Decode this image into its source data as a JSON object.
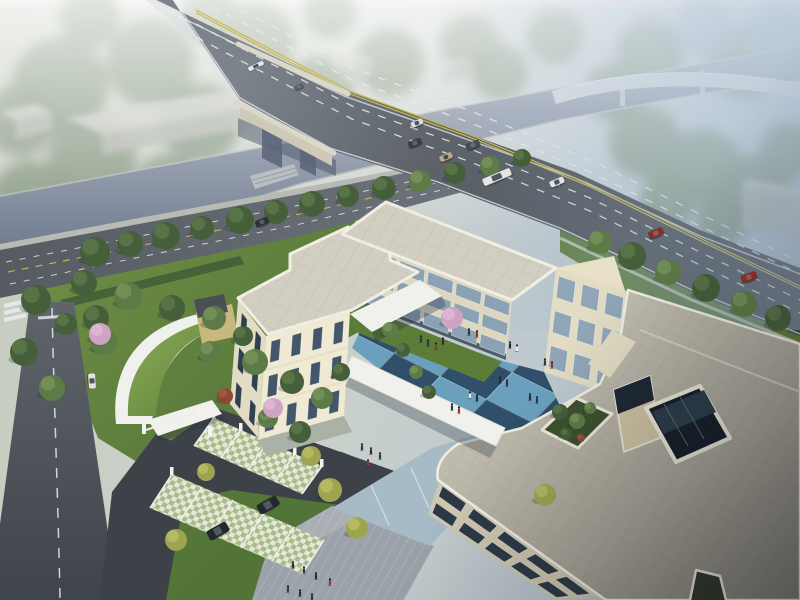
{
  "scene": {
    "type": "aerial-architectural-rendering",
    "colors": {
      "haze_top": "#ded6d5",
      "sky_left": "#c6ccbe",
      "sky_mid": "#ccd2cb",
      "sky_right": "#b3c2d1",
      "forest_green": "#7e9179",
      "forest_blue": "#93a7b5",
      "water": "#6f7b90",
      "water_far": "#97a4b3",
      "bank": "#b2b8b2",
      "road_asphalt": "#46494f",
      "road_far": "#7c838b",
      "marking_white": "#e9edef",
      "marking_yellow": "#c9b94f",
      "bridge_parapet": "#dcd8ca",
      "bridge_side": "#cfc9b8",
      "viaduct": "#c7ced4",
      "street_asphalt": "#565b62",
      "sidewalk": "#b7bbb3",
      "warehouse_roof": "#c3c6bd",
      "warehouse_face": "#acb1a8",
      "lawn": "#6e8d45",
      "lawn_dark": "#527438",
      "hedge": "#3f5c37",
      "tree_dark": "#465f3b",
      "tree_dark_hi": "#5d784a",
      "tree_mid": "#5d7b47",
      "tree_mid_hi": "#79955b",
      "tree_yellow": "#9fa451",
      "tree_yellow_hi": "#bcbe69",
      "blossom": "#cfa3c3",
      "blossom_hi": "#dfb9d3",
      "tree_red": "#8c4837",
      "tree_red_hi": "#a25c45",
      "green_roof": "#7fa24e",
      "green_roof_dark": "#5d8039",
      "drive_asphalt": "#3d4248",
      "left_road": "#54585f",
      "paver": "#c6d2ae",
      "paver_line": "#eef0e8",
      "plaza": "#9ba2a9",
      "plaza_hi": "#b2b8be",
      "path_blue": "#a7bbc7",
      "ct_light": "#6aa0bd",
      "ct_dark": "#2f4f6a",
      "ct_grass": "#5c7d38",
      "wall_lit": "#f0e9d3",
      "wall_mid": "#e3dcc4",
      "wall_shadow": "#ded7bf",
      "wall_dark": "#cfc8b0",
      "parapet": "#f1eee3",
      "roof_light": "#d2cec1",
      "roof_mid": "#c0bcae",
      "roof_dark": "#837f77",
      "glass_band": "#8ba1b4",
      "glass_dark": "#36465a",
      "arcade": "#4d5d6c",
      "atrium_dark": "#151e29",
      "canopy": "#f0f1ec",
      "sand": "#c9b87e",
      "car_dark": "#24282e"
    },
    "forest": {
      "format": [
        "x",
        "y",
        "r",
        "variant"
      ],
      "items": [
        [
          60,
          85,
          48,
          "g"
        ],
        [
          150,
          62,
          44,
          "g"
        ],
        [
          255,
          42,
          40,
          "g"
        ],
        [
          92,
          160,
          44,
          "g"
        ],
        [
          200,
          122,
          40,
          "g"
        ],
        [
          318,
          92,
          36,
          "g"
        ],
        [
          30,
          198,
          38,
          "g"
        ],
        [
          168,
          188,
          34,
          "g"
        ],
        [
          390,
          62,
          34,
          "g"
        ],
        [
          470,
          44,
          30,
          "g"
        ],
        [
          555,
          36,
          28,
          "g"
        ],
        [
          650,
          52,
          34,
          "g"
        ],
        [
          745,
          62,
          38,
          "g"
        ],
        [
          615,
          92,
          30,
          "g"
        ],
        [
          500,
          72,
          28,
          "g"
        ],
        [
          705,
          28,
          30,
          "b"
        ],
        [
          775,
          35,
          32,
          "b"
        ],
        [
          645,
          142,
          36,
          "g"
        ],
        [
          703,
          166,
          38,
          "g"
        ],
        [
          756,
          190,
          36,
          "g"
        ],
        [
          788,
          150,
          28,
          "g"
        ],
        [
          668,
          200,
          28,
          "g"
        ],
        [
          722,
          220,
          26,
          "g"
        ],
        [
          90,
          18,
          30,
          "g"
        ],
        [
          210,
          14,
          28,
          "g"
        ],
        [
          330,
          12,
          26,
          "g"
        ],
        [
          20,
          120,
          36,
          "g"
        ]
      ]
    },
    "trees": {
      "format": [
        "x",
        "y",
        "r",
        "variant"
      ],
      "items": [
        [
          95,
          252,
          15,
          "dark"
        ],
        [
          130,
          244,
          13,
          "dark"
        ],
        [
          166,
          236,
          14,
          "dark"
        ],
        [
          202,
          228,
          12,
          "dark"
        ],
        [
          240,
          220,
          14,
          "dark"
        ],
        [
          276,
          212,
          12,
          "dark"
        ],
        [
          312,
          204,
          13,
          "dark"
        ],
        [
          348,
          196,
          11,
          "dark"
        ],
        [
          384,
          188,
          12,
          "dark"
        ],
        [
          420,
          181,
          11,
          "mid"
        ],
        [
          455,
          173,
          11,
          "dark"
        ],
        [
          490,
          166,
          10,
          "mid"
        ],
        [
          522,
          158,
          9,
          "dark"
        ],
        [
          600,
          242,
          12,
          "mid"
        ],
        [
          632,
          256,
          14,
          "dark"
        ],
        [
          668,
          272,
          13,
          "mid"
        ],
        [
          706,
          288,
          14,
          "dark"
        ],
        [
          744,
          304,
          13,
          "mid"
        ],
        [
          778,
          318,
          13,
          "dark"
        ],
        [
          84,
          283,
          13,
          "dark"
        ],
        [
          128,
          296,
          14,
          "mid"
        ],
        [
          172,
          308,
          13,
          "dark"
        ],
        [
          214,
          318,
          12,
          "mid"
        ],
        [
          66,
          324,
          11,
          "dark"
        ],
        [
          104,
          342,
          13,
          "mid"
        ],
        [
          36,
          300,
          15,
          "dark"
        ],
        [
          24,
          352,
          14,
          "dark"
        ],
        [
          52,
          388,
          13,
          "mid"
        ],
        [
          96,
          318,
          13,
          "dark"
        ],
        [
          255,
          362,
          13,
          "mid"
        ],
        [
          292,
          382,
          12,
          "dark"
        ],
        [
          322,
          398,
          11,
          "mid"
        ],
        [
          341,
          372,
          9,
          "dark"
        ],
        [
          268,
          418,
          10,
          "mid"
        ],
        [
          300,
          432,
          11,
          "dark"
        ],
        [
          243,
          336,
          10,
          "dark"
        ],
        [
          210,
          352,
          11,
          "mid"
        ],
        [
          330,
          490,
          12,
          "yellow"
        ],
        [
          357,
          528,
          11,
          "yellow"
        ],
        [
          176,
          540,
          11,
          "yellow"
        ],
        [
          206,
          472,
          9,
          "yellow"
        ],
        [
          311,
          456,
          10,
          "yellow"
        ],
        [
          545,
          495,
          11,
          "yellow"
        ],
        [
          100,
          334,
          11,
          "pink"
        ],
        [
          273,
          408,
          10,
          "pink"
        ],
        [
          452,
          318,
          11,
          "pink"
        ],
        [
          225,
          396,
          8,
          "red"
        ],
        [
          390,
          330,
          8,
          "mid"
        ],
        [
          403,
          350,
          7,
          "dark"
        ],
        [
          416,
          372,
          7,
          "mid"
        ],
        [
          429,
          392,
          7,
          "dark"
        ],
        [
          560,
          412,
          8,
          "dark"
        ],
        [
          577,
          421,
          8,
          "mid"
        ],
        [
          566,
          434,
          6,
          "dark"
        ],
        [
          590,
          408,
          6,
          "mid"
        ],
        [
          581,
          438,
          4,
          "red"
        ]
      ]
    },
    "vehicles": [
      {
        "type": "car",
        "x": 417,
        "y": 123,
        "angle": -23,
        "color": "#d9dde0",
        "scale": 0.85
      },
      {
        "type": "car",
        "x": 415,
        "y": 143,
        "angle": -23,
        "color": "#3a4046",
        "scale": 0.9
      },
      {
        "type": "car",
        "x": 473,
        "y": 145,
        "angle": -23,
        "color": "#464c52",
        "scale": 0.9
      },
      {
        "type": "car",
        "x": 446,
        "y": 157,
        "angle": -23,
        "color": "#b9aa8a",
        "scale": 0.9
      },
      {
        "type": "bus",
        "x": 497,
        "y": 177,
        "angle": -23,
        "color": "#e4e6e3",
        "scale": 1
      },
      {
        "type": "pickup",
        "x": 557,
        "y": 182,
        "angle": -23,
        "color": "#e0e3e5",
        "scale": 0.95
      },
      {
        "type": "car",
        "x": 656,
        "y": 233,
        "angle": -21,
        "color": "#8e2f27",
        "scale": 1
      },
      {
        "type": "car",
        "x": 749,
        "y": 277,
        "angle": -19,
        "color": "#9a2e25",
        "scale": 1.05
      },
      {
        "type": "bus",
        "x": 256,
        "y": 66,
        "angle": -26,
        "color": "#e7e8e6",
        "scale": 0.55
      },
      {
        "type": "car",
        "x": 299,
        "y": 87,
        "angle": -26,
        "color": "#596067",
        "scale": 0.6
      },
      {
        "type": "car",
        "x": 262,
        "y": 222,
        "angle": -22,
        "color": "#2d3237",
        "scale": 0.9
      },
      {
        "type": "van",
        "x": 92,
        "y": 381,
        "angle": 86,
        "color": "#e3e4e1",
        "scale": 0.9
      },
      {
        "type": "suv",
        "x": 268,
        "y": 505,
        "angle": -29,
        "color": "#24282e",
        "scale": 1.15
      },
      {
        "type": "suv",
        "x": 218,
        "y": 531,
        "angle": -29,
        "color": "#24282e",
        "scale": 1.15
      }
    ],
    "people": [
      {
        "x": 469,
        "y": 333,
        "c": "#2b3850"
      },
      {
        "x": 477,
        "y": 335,
        "c": "#93382c"
      },
      {
        "x": 510,
        "y": 346,
        "c": "#222e3e"
      },
      {
        "x": 517,
        "y": 349,
        "c": "#e6e7e7"
      },
      {
        "x": 545,
        "y": 363,
        "c": "#2b3850"
      },
      {
        "x": 552,
        "y": 366,
        "c": "#93382c"
      },
      {
        "x": 500,
        "y": 381,
        "c": "#222e3e"
      },
      {
        "x": 507,
        "y": 384,
        "c": "#2b3850"
      },
      {
        "x": 470,
        "y": 396,
        "c": "#e6e7e7"
      },
      {
        "x": 477,
        "y": 399,
        "c": "#222e3e"
      },
      {
        "x": 452,
        "y": 408,
        "c": "#2b3850"
      },
      {
        "x": 459,
        "y": 411,
        "c": "#93382c"
      },
      {
        "x": 530,
        "y": 398,
        "c": "#222e3e"
      },
      {
        "x": 537,
        "y": 401,
        "c": "#2b3850"
      },
      {
        "x": 428,
        "y": 344,
        "c": "#2b3850"
      },
      {
        "x": 436,
        "y": 347,
        "c": "#93382c"
      },
      {
        "x": 443,
        "y": 342,
        "c": "#222e3e"
      },
      {
        "x": 421,
        "y": 340,
        "c": "#2b3850"
      },
      {
        "x": 293,
        "y": 566,
        "c": "#222e3e"
      },
      {
        "x": 304,
        "y": 571,
        "c": "#2b3850"
      },
      {
        "x": 316,
        "y": 577,
        "c": "#222e3e"
      },
      {
        "x": 288,
        "y": 590,
        "c": "#2b3850"
      },
      {
        "x": 300,
        "y": 594,
        "c": "#222e3e"
      },
      {
        "x": 312,
        "y": 598,
        "c": "#2b3850"
      },
      {
        "x": 330,
        "y": 583,
        "c": "#93382c"
      },
      {
        "x": 362,
        "y": 448,
        "c": "#2b3850"
      },
      {
        "x": 371,
        "y": 452,
        "c": "#222e3e"
      },
      {
        "x": 380,
        "y": 457,
        "c": "#2b3850"
      },
      {
        "x": 368,
        "y": 464,
        "c": "#93382c"
      }
    ],
    "facades": [
      {
        "id": "left-south",
        "quad": [
          [
            266,
            336
          ],
          [
            350,
            312
          ],
          [
            344,
            416
          ],
          [
            258,
            440
          ]
        ],
        "floors": 3,
        "cols": 4,
        "glass": "#44566a",
        "wu": [
          0.28,
          0.72
        ]
      },
      {
        "id": "left-west",
        "quad": [
          [
            238,
            300
          ],
          [
            266,
            336
          ],
          [
            258,
            438
          ],
          [
            230,
            404
          ]
        ],
        "floors": 3,
        "cols": 2,
        "glass": "#31404e",
        "wu": [
          0.3,
          0.7
        ]
      },
      {
        "id": "north-wing",
        "quad": [
          [
            342,
            234
          ],
          [
            512,
            300
          ],
          [
            506,
            360
          ],
          [
            336,
            294
          ]
        ],
        "floors": 3,
        "cols": 6,
        "glass": "#8ba1b4",
        "wu": [
          0.06,
          0.94
        ]
      },
      {
        "id": "east-court",
        "quad": [
          [
            556,
            268
          ],
          [
            628,
            292
          ],
          [
            616,
            396
          ],
          [
            544,
            372
          ]
        ],
        "floors": 3,
        "cols": 3,
        "glass": "#90a6b8",
        "wu": [
          0.15,
          0.85
        ]
      },
      {
        "id": "front-sw",
        "quad": [
          [
            440,
            480
          ],
          [
            598,
            596
          ],
          [
            556,
            600
          ],
          [
            428,
            514
          ]
        ],
        "floors": 2,
        "cols": 5,
        "glass": "#2c3945",
        "wu": [
          0.12,
          0.88
        ]
      }
    ]
  }
}
